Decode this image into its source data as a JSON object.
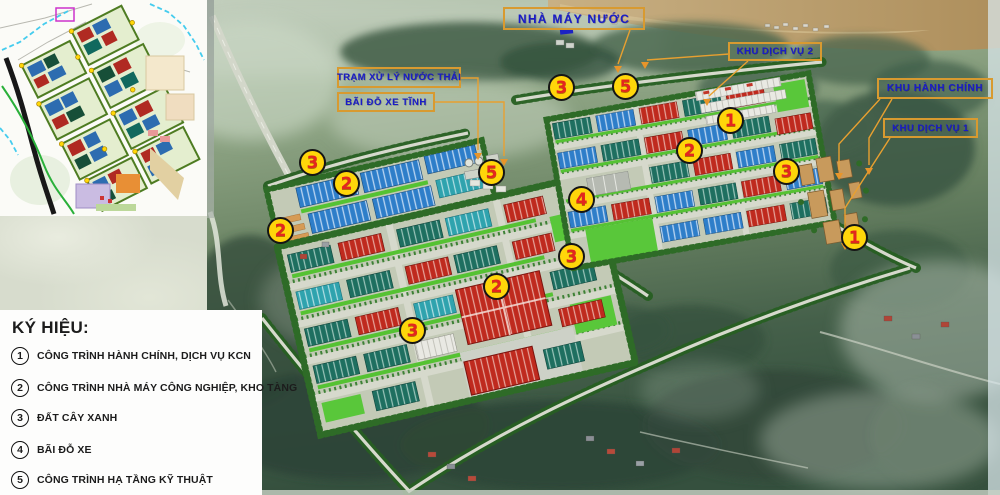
{
  "legend": {
    "title": "KÝ HIỆU:",
    "items": [
      {
        "num": "1",
        "label": "CÔNG TRÌNH HÀNH CHÍNH, DỊCH VỤ KCN"
      },
      {
        "num": "2",
        "label": "CÔNG TRÌNH NHÀ MÁY CÔNG NGHIỆP, KHO TÀNG"
      },
      {
        "num": "3",
        "label": "ĐẤT CÂY XANH"
      },
      {
        "num": "4",
        "label": "BÃI ĐỖ XE"
      },
      {
        "num": "5",
        "label": "CÔNG TRÌNH HẠ TẦNG KỸ THUẬT"
      }
    ]
  },
  "map_labels": [
    {
      "text": "NHÀ MÁY NƯỚC"
    },
    {
      "text": "TRẠM XỬ LÝ NƯỚC THẢI"
    },
    {
      "text": "BÃI ĐỖ XE TĨNH"
    },
    {
      "text": "KHU DỊCH VỤ 2"
    },
    {
      "text": "KHU HÀNH CHÍNH"
    },
    {
      "text": "KHU DỊCH VỤ 1"
    }
  ],
  "markers": [
    {
      "num": "3"
    },
    {
      "num": "2"
    },
    {
      "num": "2"
    },
    {
      "num": "3"
    },
    {
      "num": "5"
    },
    {
      "num": "1"
    },
    {
      "num": "2"
    },
    {
      "num": "3"
    },
    {
      "num": "5"
    },
    {
      "num": "4"
    },
    {
      "num": "3"
    },
    {
      "num": "2"
    },
    {
      "num": "3"
    },
    {
      "num": "1"
    }
  ],
  "colors": {
    "label_text": "#1a1cc8",
    "label_border": "#d89a30",
    "marker_fill": "#ffd60a",
    "marker_number": "#e3261f",
    "legend_text": "#1c1c1c"
  }
}
